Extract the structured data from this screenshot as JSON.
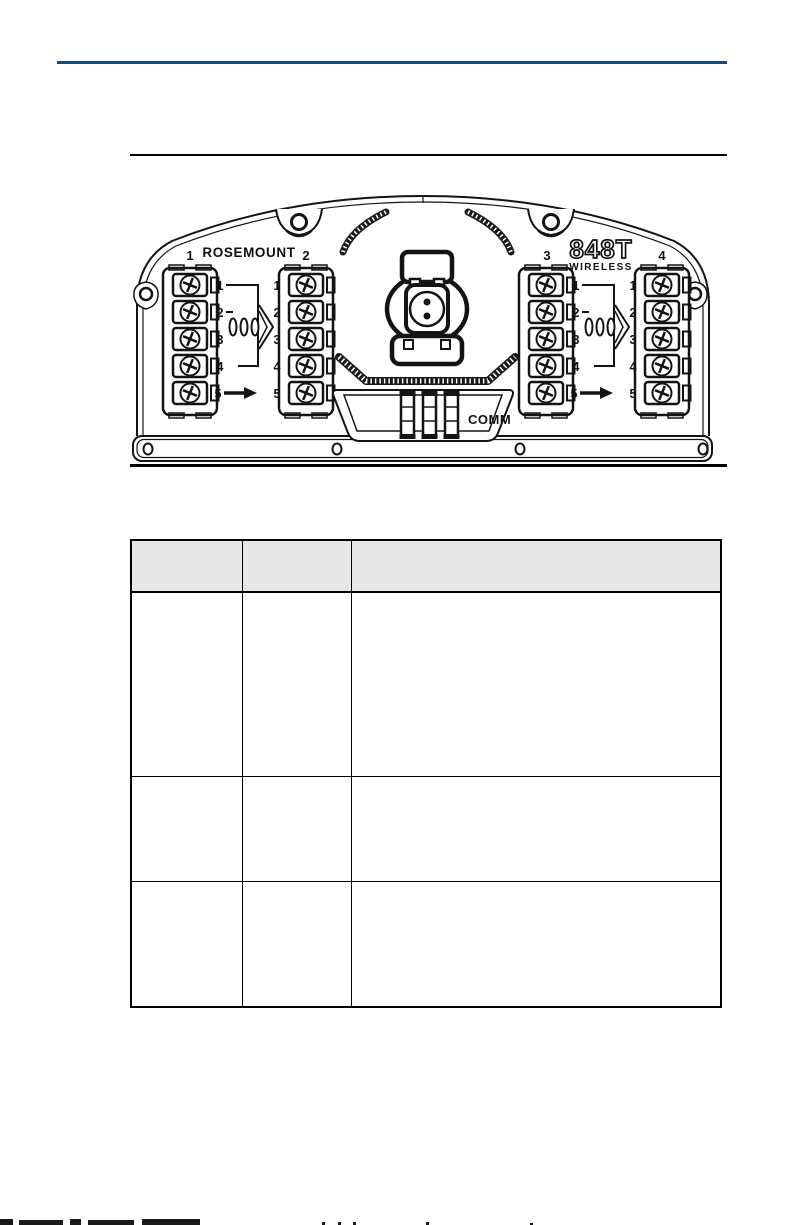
{
  "colors": {
    "accent_rule": "#17497D",
    "table_header_bg": "#E7E7E7",
    "ink": "#141414"
  },
  "figure": {
    "brand": "ROSEMOUNT",
    "model": "848T",
    "model_subtitle": "WIRELESS",
    "comm_label": "COMM",
    "block_labels": [
      "1",
      "2",
      "3",
      "4"
    ],
    "terminal_numbers": [
      "1",
      "2",
      "3",
      "4",
      "5"
    ]
  },
  "table": {
    "columns": [
      {
        "label": ""
      },
      {
        "label": ""
      },
      {
        "label": ""
      }
    ],
    "rows": [
      [
        "",
        "",
        ""
      ],
      [
        "",
        "",
        ""
      ],
      [
        "",
        "",
        ""
      ]
    ]
  }
}
